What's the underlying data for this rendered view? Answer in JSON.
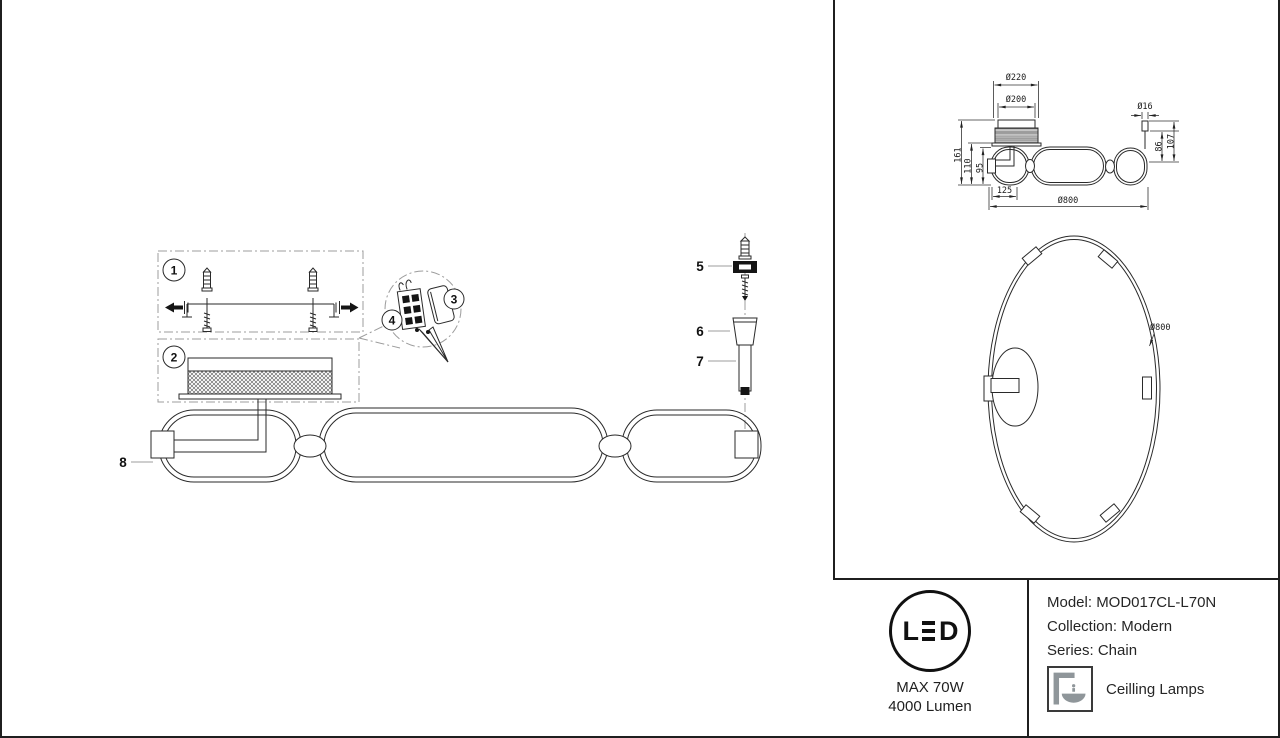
{
  "info": {
    "led": "LED",
    "max_power": "MAX 70W",
    "luminous_flux": "4000 Lumen",
    "model": "Model: MOD017CL-L70N",
    "collection": "Collection: Modern",
    "series": "Series: Chain",
    "category": "Ceilling Lamps"
  },
  "install": {
    "step_1": "1",
    "step_2": "2",
    "step_3": "3",
    "step_4": "4",
    "part_5": "5",
    "part_6": "6",
    "part_7": "7",
    "part_8": "8"
  },
  "dims": {
    "side": {
      "dia220": "Ø220",
      "dia200": "Ø200",
      "dia16": "Ø16",
      "h161": "161",
      "h110": "110",
      "h95": "95",
      "h86": "86",
      "h107": "107",
      "w125": "125",
      "dia800": "Ø800"
    },
    "bottom": {
      "dia800": "Ø800"
    }
  },
  "colors": {
    "line": "#2a2a2a",
    "dashdot": "#9c9c9c",
    "text": "#1a1a1a",
    "icon_gray": "#8f969a"
  }
}
